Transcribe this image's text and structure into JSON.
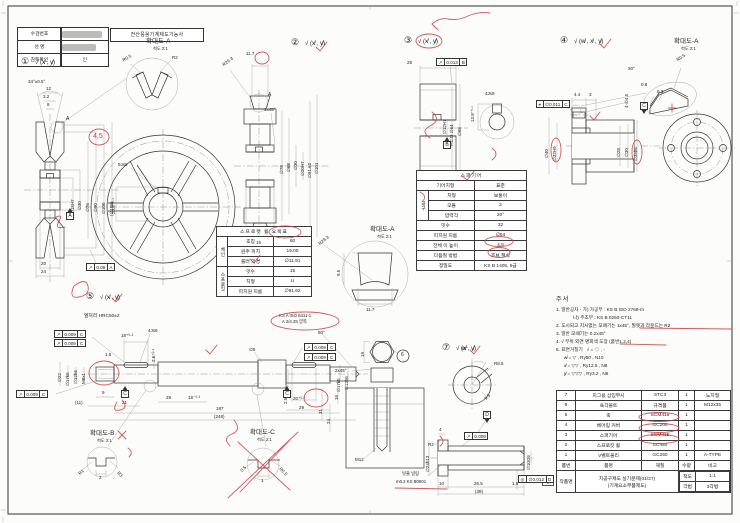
{
  "titleblock": {
    "exam_title": "전산응용기계제도기능사",
    "rows": [
      {
        "label": "수검번호",
        "value": ""
      },
      {
        "label": "성    명",
        "value": ""
      },
      {
        "label": "감독확인",
        "value": "인"
      }
    ]
  },
  "stamp": "인",
  "notes": {
    "title": "주서",
    "lines": [
      "1. 일반공차 - 가) 가공부 : KS B ISO 2768-m",
      "             나) 주조부 : KS B 0250-CT11",
      "2. 도시되고 지시없는 모떼기는 1x45°, 필렛과 라운드는 R2",
      "3. 일반 모떼기는 0.2x45°",
      "4. √ 부위 외면 명회색 도장 (품번1,2,4)",
      "5. 표면거칠기   √ = ◇ , -",
      "      w̸ = ▽ , Ry50 , N10",
      "      x̸ = ▽▽ , Ry12.5 , N8",
      "      y̸ = ▽▽▽ , Ry3.2 , N6"
    ]
  },
  "sprocket_table": {
    "title": "스프로켓 휠 요목표",
    "groups": [
      {
        "name": "체인",
        "rows": [
          [
            "호칭",
            "60"
          ],
          [
            "원주 피치",
            "19.05"
          ],
          [
            "롤러 외경",
            "∅11.91"
          ]
        ]
      },
      {
        "name": "스프로킷",
        "rows": [
          [
            "잇수",
            "15"
          ],
          [
            "치형",
            "U"
          ],
          [
            "피치원 지름",
            "∅91.62"
          ]
        ]
      }
    ]
  },
  "gear_table": {
    "title": "스퍼기어",
    "rows": [
      {
        "l": "기어치형",
        "v": "표준",
        "span": 2
      },
      {
        "g": "공구",
        "gspan": 3,
        "l": "치형",
        "v": "보통이"
      },
      {
        "l": "모듈",
        "v": "2"
      },
      {
        "l": "압력각",
        "v": "20°"
      },
      {
        "l": "잇수",
        "v": "32",
        "span": 2
      },
      {
        "l": "피치원 지름",
        "v": "∅64",
        "span": 2
      },
      {
        "l": "전체 이 높이",
        "v": "4.5",
        "span": 2
      },
      {
        "l": "다듬질 방법",
        "v": "호브 절삭",
        "span": 2
      },
      {
        "l": "정밀도",
        "v": "KS B 1405, 5급",
        "span": 2
      }
    ]
  },
  "parts_table": {
    "headers": [
      "품번",
      "품명",
      "재질",
      "수량",
      "비고"
    ],
    "rows": [
      [
        "7",
        "지그용 삽입부시",
        "STC3",
        "1",
        "노치형"
      ],
      [
        "6",
        "육각볼트",
        "규격품",
        "1",
        "M12x35"
      ],
      [
        "5",
        "축",
        "SCM415",
        "1",
        ""
      ],
      [
        "4",
        "베어링 커버",
        "GC200",
        "1",
        ""
      ],
      [
        "3",
        "스퍼기어",
        "SCM415",
        "1",
        ""
      ],
      [
        "2",
        "스프로킷 휠",
        "SC450",
        "1",
        ""
      ],
      [
        "1",
        "V벨트풀리",
        "GC250",
        "1",
        "A-TYPE"
      ]
    ],
    "footer": {
      "label": "작품명",
      "title_line1": "치공구제도 실기문제(01/27)",
      "title_line2": "(기계요소부품제도)",
      "scale_label": "척도",
      "scale": "1:1",
      "method_label": "각법",
      "method": "3각법"
    }
  },
  "labels": [
    {
      "t": "①",
      "x": 21,
      "y": 57,
      "s": 9
    },
    {
      "t": "√ (x̸ , y̸)",
      "x": 35,
      "y": 60,
      "s": 6
    },
    {
      "t": "②",
      "x": 291,
      "y": 38,
      "s": 9
    },
    {
      "t": "√ (x̸ , y̸)",
      "x": 305,
      "y": 41,
      "s": 6
    },
    {
      "t": "③",
      "x": 404,
      "y": 36,
      "s": 9
    },
    {
      "t": "√ (x̸ , y̸)",
      "x": 418,
      "y": 39,
      "s": 6
    },
    {
      "t": "④",
      "x": 560,
      "y": 36,
      "s": 9
    },
    {
      "t": "√ (w̸ , x̸ , y̸)",
      "x": 574,
      "y": 39,
      "s": 6
    },
    {
      "t": "⑤",
      "x": 86,
      "y": 292,
      "s": 9
    },
    {
      "t": "√ (x̸ , y̸)",
      "x": 100,
      "y": 295,
      "s": 6
    },
    {
      "t": "⑦",
      "x": 442,
      "y": 343,
      "s": 9
    },
    {
      "t": "√ (x̸ , y̸)",
      "x": 456,
      "y": 346,
      "s": 6
    },
    {
      "t": "6",
      "x": 401,
      "y": 353,
      "s": 5
    },
    {
      "t": "확대도-A",
      "x": 146,
      "y": 38,
      "s": 6.5
    },
    {
      "t": "척도 2:1",
      "x": 153,
      "y": 47,
      "s": 4.2
    },
    {
      "t": "확대도-A",
      "x": 370,
      "y": 226,
      "s": 6.5
    },
    {
      "t": "척도 2:1",
      "x": 377,
      "y": 235,
      "s": 4.2
    },
    {
      "t": "확대도-A",
      "x": 674,
      "y": 38,
      "s": 6.5
    },
    {
      "t": "척도 2:1",
      "x": 681,
      "y": 47,
      "s": 4.2
    },
    {
      "t": "확대도-B",
      "x": 90,
      "y": 430,
      "s": 6.5
    },
    {
      "t": "척도 2:1",
      "x": 97,
      "y": 439,
      "s": 4.2
    },
    {
      "t": "확대도-C",
      "x": 250,
      "y": 429,
      "s": 6.5
    },
    {
      "t": "척도 2:1",
      "x": 257,
      "y": 438,
      "s": 4.2
    },
    {
      "t": "34°±0.5°",
      "x": 28,
      "y": 80
    },
    {
      "t": "12",
      "x": 46,
      "y": 87
    },
    {
      "t": "3.2",
      "x": 43,
      "y": 95
    },
    {
      "t": "8",
      "x": 47,
      "y": 103
    },
    {
      "t": "A",
      "x": 66,
      "y": 117,
      "s": 5
    },
    {
      "t": "∅18H7",
      "x": 71,
      "y": 214,
      "r": -90
    },
    {
      "t": "∅30",
      "x": 78,
      "y": 210,
      "r": -90
    },
    {
      "t": "∅76",
      "x": 86,
      "y": 212,
      "r": -90
    },
    {
      "t": "∅90",
      "x": 94,
      "y": 212,
      "r": -90
    },
    {
      "t": "∅100",
      "x": 102,
      "y": 214,
      "r": -90
    },
    {
      "t": "(∅105)",
      "x": 110,
      "y": 216,
      "r": -90
    },
    {
      "t": "20",
      "x": 41,
      "y": 262
    },
    {
      "t": "24",
      "x": 41,
      "y": 270
    },
    {
      "t": "4,5",
      "x": 93,
      "y": 133,
      "s": 7,
      "c": "#c64040"
    },
    {
      "t": "R0.5",
      "x": 122,
      "y": 59,
      "r": -30
    },
    {
      "t": "R2",
      "x": 172,
      "y": 56
    },
    {
      "t": "5Js9",
      "x": 118,
      "y": 163
    },
    {
      "t": "20.8⁺⁰·¹",
      "x": 112,
      "y": 214,
      "r": -90
    },
    {
      "t": "A",
      "x": 268,
      "y": 93,
      "s": 5
    },
    {
      "t": "11.7",
      "x": 246,
      "y": 52
    },
    {
      "t": "R29.3",
      "x": 222,
      "y": 64,
      "r": -38
    },
    {
      "t": "1x45°",
      "x": 264,
      "y": 108
    },
    {
      "t": "∅78",
      "x": 280,
      "y": 174,
      "r": -90
    },
    {
      "t": "∅68",
      "x": 287,
      "y": 172,
      "r": -90
    },
    {
      "t": "∅30",
      "x": 294,
      "y": 170,
      "r": -90
    },
    {
      "t": "∅20H7",
      "x": 301,
      "y": 176,
      "r": -90
    },
    {
      "t": "∅91.62",
      "x": 308,
      "y": 178,
      "r": -90
    },
    {
      "t": "∅101",
      "x": 315,
      "y": 174,
      "r": -90
    },
    {
      "t": "15",
      "x": 256,
      "y": 241
    },
    {
      "t": "R29.3",
      "x": 318,
      "y": 243,
      "r": -40
    },
    {
      "t": "9.5",
      "x": 337,
      "y": 276,
      "r": -90
    },
    {
      "t": "11.7",
      "x": 366,
      "y": 308
    },
    {
      "t": "28",
      "x": 407,
      "y": 61
    },
    {
      "t": "∅12H7",
      "x": 443,
      "y": 134,
      "r": -90
    },
    {
      "t": "P.C.D ∅64",
      "x": 450,
      "y": 146,
      "r": -90
    },
    {
      "t": "∅68",
      "x": 458,
      "y": 136,
      "r": -90
    },
    {
      "t": "4Js9",
      "x": 485,
      "y": 92
    },
    {
      "t": "13.8⁺⁰·¹",
      "x": 471,
      "y": 122,
      "r": -90
    },
    {
      "t": "4.4",
      "x": 574,
      "y": 93
    },
    {
      "t": "3",
      "x": 589,
      "y": 93
    },
    {
      "t": "4-∅4.5",
      "x": 625,
      "y": 108,
      "r": -90
    },
    {
      "t": "∅40",
      "x": 545,
      "y": 158,
      "r": -90
    },
    {
      "t": "∅32H9",
      "x": 553,
      "y": 161,
      "r": -90
    },
    {
      "t": "∅28",
      "x": 617,
      "y": 157,
      "r": -90
    },
    {
      "t": "∅30",
      "x": 625,
      "y": 157,
      "r": -90
    },
    {
      "t": "∅35h6",
      "x": 634,
      "y": 161,
      "r": -90
    },
    {
      "t": "R0.5",
      "x": 676,
      "y": 59,
      "r": -35
    },
    {
      "t": "30°",
      "x": 628,
      "y": 67
    },
    {
      "t": "0.8",
      "x": 641,
      "y": 83
    },
    {
      "t": "6.3",
      "x": 657,
      "y": 90
    },
    {
      "t": "열처리 HRC50±2",
      "x": 84,
      "y": 314,
      "s": 4.8
    },
    {
      "t": "KS A ISO 6411-1",
      "x": 279,
      "y": 314,
      "s": 4.3
    },
    {
      "t": "A 2/4.25 양쪽",
      "x": 282,
      "y": 320,
      "s": 4.3
    },
    {
      "t": "18⁺⁰·²",
      "x": 121,
      "y": 334
    },
    {
      "t": "4Js9",
      "x": 148,
      "y": 329
    },
    {
      "t": "2.5⁺⁰·¹",
      "x": 152,
      "y": 362,
      "r": -90
    },
    {
      "t": "1.5",
      "x": 105,
      "y": 353
    },
    {
      "t": "∅22",
      "x": 58,
      "y": 382,
      "r": -90
    },
    {
      "t": "∅17k5",
      "x": 66,
      "y": 386,
      "r": -90
    },
    {
      "t": "∅12h6",
      "x": 74,
      "y": 384,
      "r": -90
    },
    {
      "t": "M8x1",
      "x": 82,
      "y": 384,
      "r": -90
    },
    {
      "t": "9",
      "x": 102,
      "y": 391
    },
    {
      "t": "(11)",
      "x": 75,
      "y": 401
    },
    {
      "t": "21",
      "x": 122,
      "y": 401
    },
    {
      "t": "29",
      "x": 166,
      "y": 396
    },
    {
      "t": "18⁻⁰·²",
      "x": 188,
      "y": 396
    },
    {
      "t": "187",
      "x": 216,
      "y": 407
    },
    {
      "t": "(248)",
      "x": 214,
      "y": 415
    },
    {
      "t": "90°",
      "x": 318,
      "y": 331
    },
    {
      "t": "∅5",
      "x": 249,
      "y": 348
    },
    {
      "t": "20⁺⁰·²",
      "x": 293,
      "y": 397
    },
    {
      "t": "29",
      "x": 299,
      "y": 406
    },
    {
      "t": "2.5⁺⁰·¹",
      "x": 284,
      "y": 404,
      "r": -90
    },
    {
      "t": "∅17k5",
      "x": 337,
      "y": 392,
      "r": -90
    },
    {
      "t": "∅12h6",
      "x": 345,
      "y": 390,
      "r": -90
    },
    {
      "t": "19",
      "x": 361,
      "y": 357,
      "r": -90
    },
    {
      "t": "2x45°",
      "x": 335,
      "y": 369
    },
    {
      "t": "16",
      "x": 335,
      "y": 400,
      "r": -90
    },
    {
      "t": "24",
      "x": 327,
      "y": 424,
      "r": -90
    },
    {
      "t": "31",
      "x": 319,
      "y": 414,
      "r": -90
    },
    {
      "t": "M12",
      "x": 355,
      "y": 458
    },
    {
      "t": "30°",
      "x": 461,
      "y": 347
    },
    {
      "t": "R8.5",
      "x": 494,
      "y": 362
    },
    {
      "t": "9.5",
      "x": 484,
      "y": 398,
      "r": -45
    },
    {
      "t": "4",
      "x": 439,
      "y": 428
    },
    {
      "t": "R2",
      "x": 428,
      "y": 443
    },
    {
      "t": "∅24h13",
      "x": 426,
      "y": 472,
      "r": -90
    },
    {
      "t": "빗줄 널링",
      "x": 402,
      "y": 472,
      "s": 4.3
    },
    {
      "t": "m0.2 KS B0901",
      "x": 396,
      "y": 480,
      "s": 4.3
    },
    {
      "t": "10",
      "x": 439,
      "y": 482
    },
    {
      "t": "26.5",
      "x": 474,
      "y": 482
    },
    {
      "t": "1.5",
      "x": 512,
      "y": 482
    },
    {
      "t": "(38)",
      "x": 475,
      "y": 490
    },
    {
      "t": "∅10G6",
      "x": 527,
      "y": 470,
      "r": -90
    },
    {
      "t": "R1",
      "x": 78,
      "y": 473,
      "r": -45
    },
    {
      "t": "R3",
      "x": 119,
      "y": 471,
      "r": 45
    },
    {
      "t": "2",
      "x": 99,
      "y": 476
    },
    {
      "t": "0.5",
      "x": 240,
      "y": 470,
      "r": -45
    },
    {
      "t": "R0.5",
      "x": 281,
      "y": 467,
      "r": 45
    },
    {
      "t": "1",
      "x": 261,
      "y": 479
    }
  ],
  "frames": [
    {
      "s": "↗",
      "v": "0.05",
      "d": "A",
      "x": 86,
      "y": 263
    },
    {
      "s": "↗",
      "v": "0.013",
      "d": "B",
      "x": 436,
      "y": 58
    },
    {
      "s": "⌖",
      "v": "∅0.011",
      "d": "C",
      "x": 536,
      "y": 100
    },
    {
      "s": "↗",
      "v": "0.009",
      "d": "C",
      "x": 54,
      "y": 330
    },
    {
      "s": "↗",
      "v": "0.009",
      "d": "C",
      "x": 54,
      "y": 339
    },
    {
      "s": "↗",
      "v": "0.009",
      "d": "C",
      "x": 16,
      "y": 390
    },
    {
      "s": "↗",
      "v": "0.009",
      "d": "C",
      "x": 304,
      "y": 343
    },
    {
      "s": "↗",
      "v": "0.009",
      "d": "C",
      "x": 304,
      "y": 353
    },
    {
      "s": "↗",
      "v": "0.009",
      "d": "",
      "x": 464,
      "y": 432
    },
    {
      "s": "◎",
      "v": "∅0.012",
      "d": "D",
      "x": 518,
      "y": 475
    }
  ],
  "datums": [
    {
      "d": "A",
      "x": 66,
      "y": 212
    },
    {
      "d": "B",
      "x": 443,
      "y": 141
    },
    {
      "d": "C",
      "x": 640,
      "y": 102,
      "tri": "bottom"
    },
    {
      "d": "C",
      "x": 121,
      "y": 390
    },
    {
      "d": "C",
      "x": 283,
      "y": 390
    },
    {
      "d": "D",
      "x": 483,
      "y": 411,
      "tri": "bottom"
    }
  ]
}
